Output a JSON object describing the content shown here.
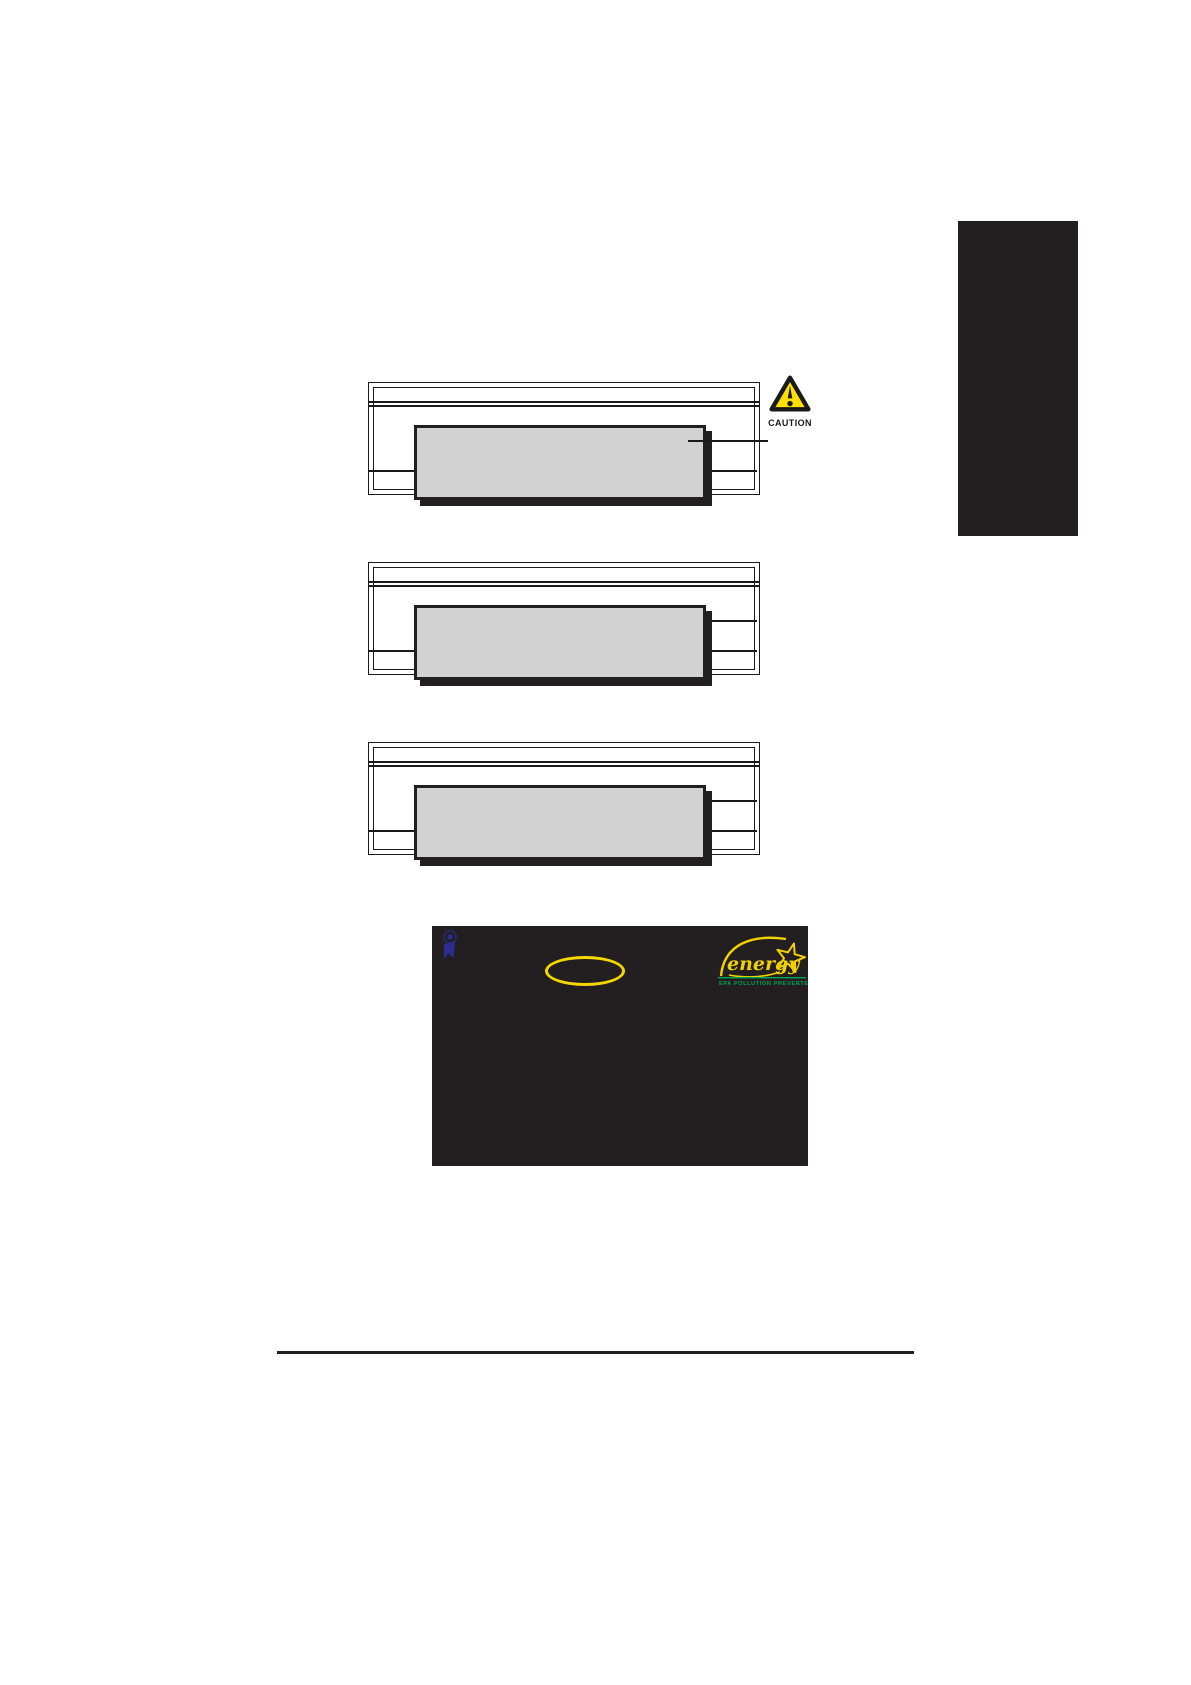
{
  "page": {
    "background": "#ffffff"
  },
  "chapter_tab": {
    "color": "#231f20"
  },
  "diagram": {
    "module_fill": "#d2d2d2",
    "shadow_color": "#231f20",
    "line_color": "#1a1a1a"
  },
  "caution": {
    "label": "CAUTION",
    "triangle_fill": "#ffe000",
    "triangle_stroke": "#1a1a1a",
    "label_color": "#1a1a1a"
  },
  "post_screen": {
    "background": "#231f20",
    "highlight_ellipse_color": "#f5d800",
    "ribbon_color": "#2b2e90",
    "energy_star": {
      "word": "energy",
      "tagline": "EPA  POLLUTION PREVENTER",
      "yellow": "#f2d100",
      "green": "#00a551"
    }
  },
  "footer": {
    "rule_color": "#231f20"
  }
}
